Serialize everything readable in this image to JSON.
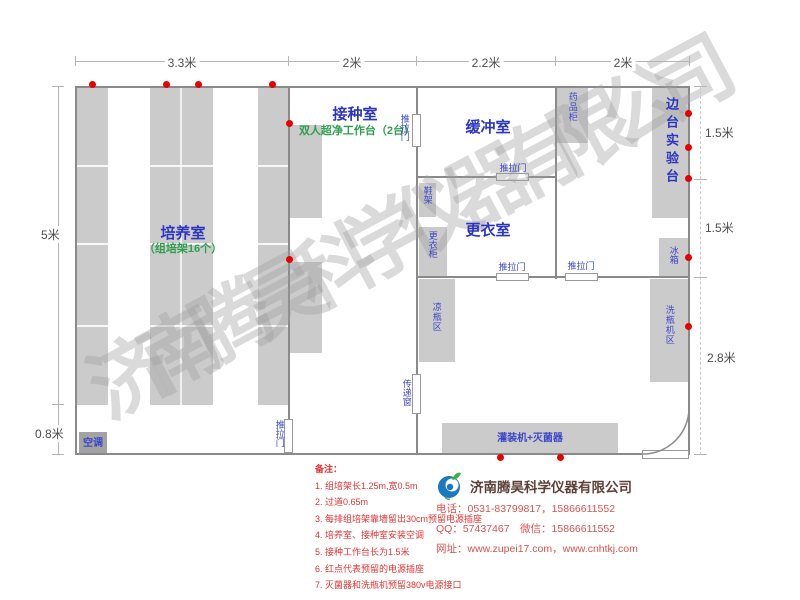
{
  "title": "组培实验室平面布局图",
  "colors": {
    "wall": "#8a8a8a",
    "furniture_fill": "#cbcbcb",
    "air_conditioner_fill": "#a3a3a3",
    "room_label_blue": "#2b35c0",
    "sub_label_green": "#2f9e4f",
    "equip_label_blue": "#3a46c8",
    "dimension_text": "#4d4d4d",
    "outlet_dot_red": "#e60000",
    "notes_red": "#e63232",
    "contact_red": "#d9534f",
    "company_name_brown": "#5d4037",
    "watermark_gray": "#9e9e9e"
  },
  "dims": {
    "top": [
      "3.3米",
      "2米",
      "2.2米",
      "2米"
    ],
    "left": [
      "5米",
      "0.8米"
    ],
    "right": [
      "1.5米",
      "1.5米",
      "2.8米"
    ]
  },
  "rooms": {
    "cultivation_name": "培养室",
    "cultivation_sub": "（组培架16个）",
    "inoculation_name": "接种室",
    "inoculation_sub": "双人超净工作台（2台）",
    "buffer_name": "缓冲室",
    "changing_name": "更衣室",
    "side_bench_name": "边台实验台"
  },
  "equipment": {
    "sliding_door": "推拉门",
    "pass_window": "传递窗",
    "medicine_cabinet": "药品柜",
    "shoe_rack": "鞋架",
    "wardrobe": "更衣柜",
    "cool_bottle_area": "凉瓶区",
    "fridge": "冰箱",
    "bottle_washer_area": "洗瓶机区",
    "filling_sterilizer": "灌装机+灭菌器",
    "air_conditioner": "空调"
  },
  "notes": {
    "title": "备注：",
    "items": [
      "1. 组培架长1.25m,宽0.5m",
      "2. 过道0.65m",
      "3. 每排组培架靠墙留出30cm预留电源插座",
      "4. 培养室、接种室安装空调",
      "5. 接种工作台长为1.5米",
      "6. 红点代表预留的电源插座",
      "7. 灭菌器和洗瓶机预留380v电源接口"
    ]
  },
  "company": {
    "name": "济南腾昊科学仪器有限公司",
    "phone": "电话：0531-83799817，15866611552",
    "qq_wechat": "QQ：57437467　微信：15866611552",
    "website": "网址：www.zupei17.com，www.cnhtkj.com"
  },
  "watermark": "济南腾昊科学仪器有限公司"
}
